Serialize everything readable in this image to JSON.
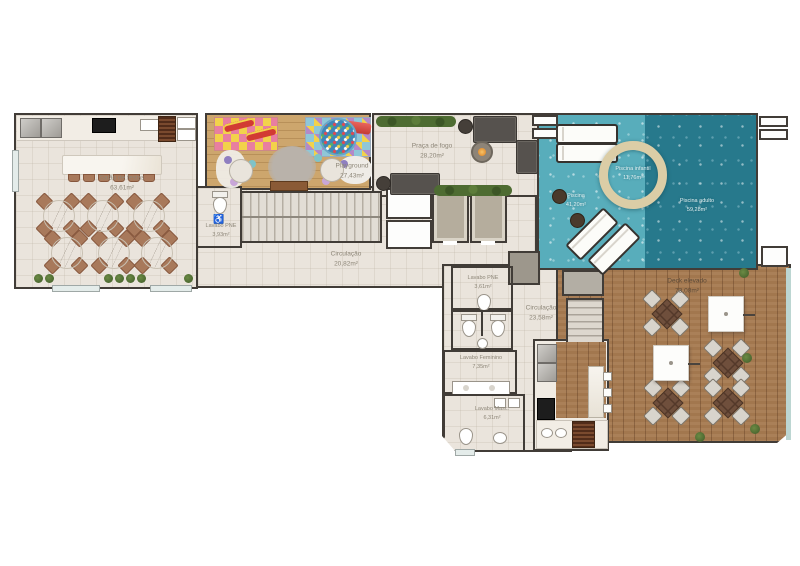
{
  "plan": {
    "type": "residential amenity floor plan",
    "rooms": [
      {
        "name": "Salão de festas",
        "area": "63,61m²"
      },
      {
        "name": "Lavabo PNE",
        "area": "3,93m²"
      },
      {
        "name": "Playground",
        "area": "27,43m²"
      },
      {
        "name": "Circulação",
        "area": "20,82m²"
      },
      {
        "name": "Praça de fogo",
        "area": "28,20m²"
      },
      {
        "name": "Piscina",
        "area": "41,20m²"
      },
      {
        "name": "Piscina infantil",
        "area": "11,76m²"
      },
      {
        "name": "Piscina adulto",
        "area": "59,28m²"
      },
      {
        "name": "Deck elevado",
        "area": "73,08m²"
      },
      {
        "name": "Lavabo PNE",
        "area": "3,61m²"
      },
      {
        "name": "Circulação",
        "area": "23,58m²"
      },
      {
        "name": "Lavabo Feminino",
        "area": "7,35m²"
      },
      {
        "name": "Lavabo Masc.",
        "area": "6,31m²"
      }
    ],
    "icons": [
      {
        "name": "wheelchair-icon",
        "glyph": "♿"
      }
    ],
    "colors": {
      "wall": "#413c37",
      "tile_floor": "#eae4dc",
      "playground_wood": "#cda66d",
      "deck_wood": "#a77b51",
      "pool_light": "#58adbb",
      "pool_dark": "#27798c",
      "pool_ring": "#dbcda6",
      "hedge_green": "#4e6c32",
      "chair_brown": "#a8795b",
      "label_text": "#8d8678",
      "water_label_text": "#e3f1f2",
      "fire_glow": "#e09032"
    }
  }
}
